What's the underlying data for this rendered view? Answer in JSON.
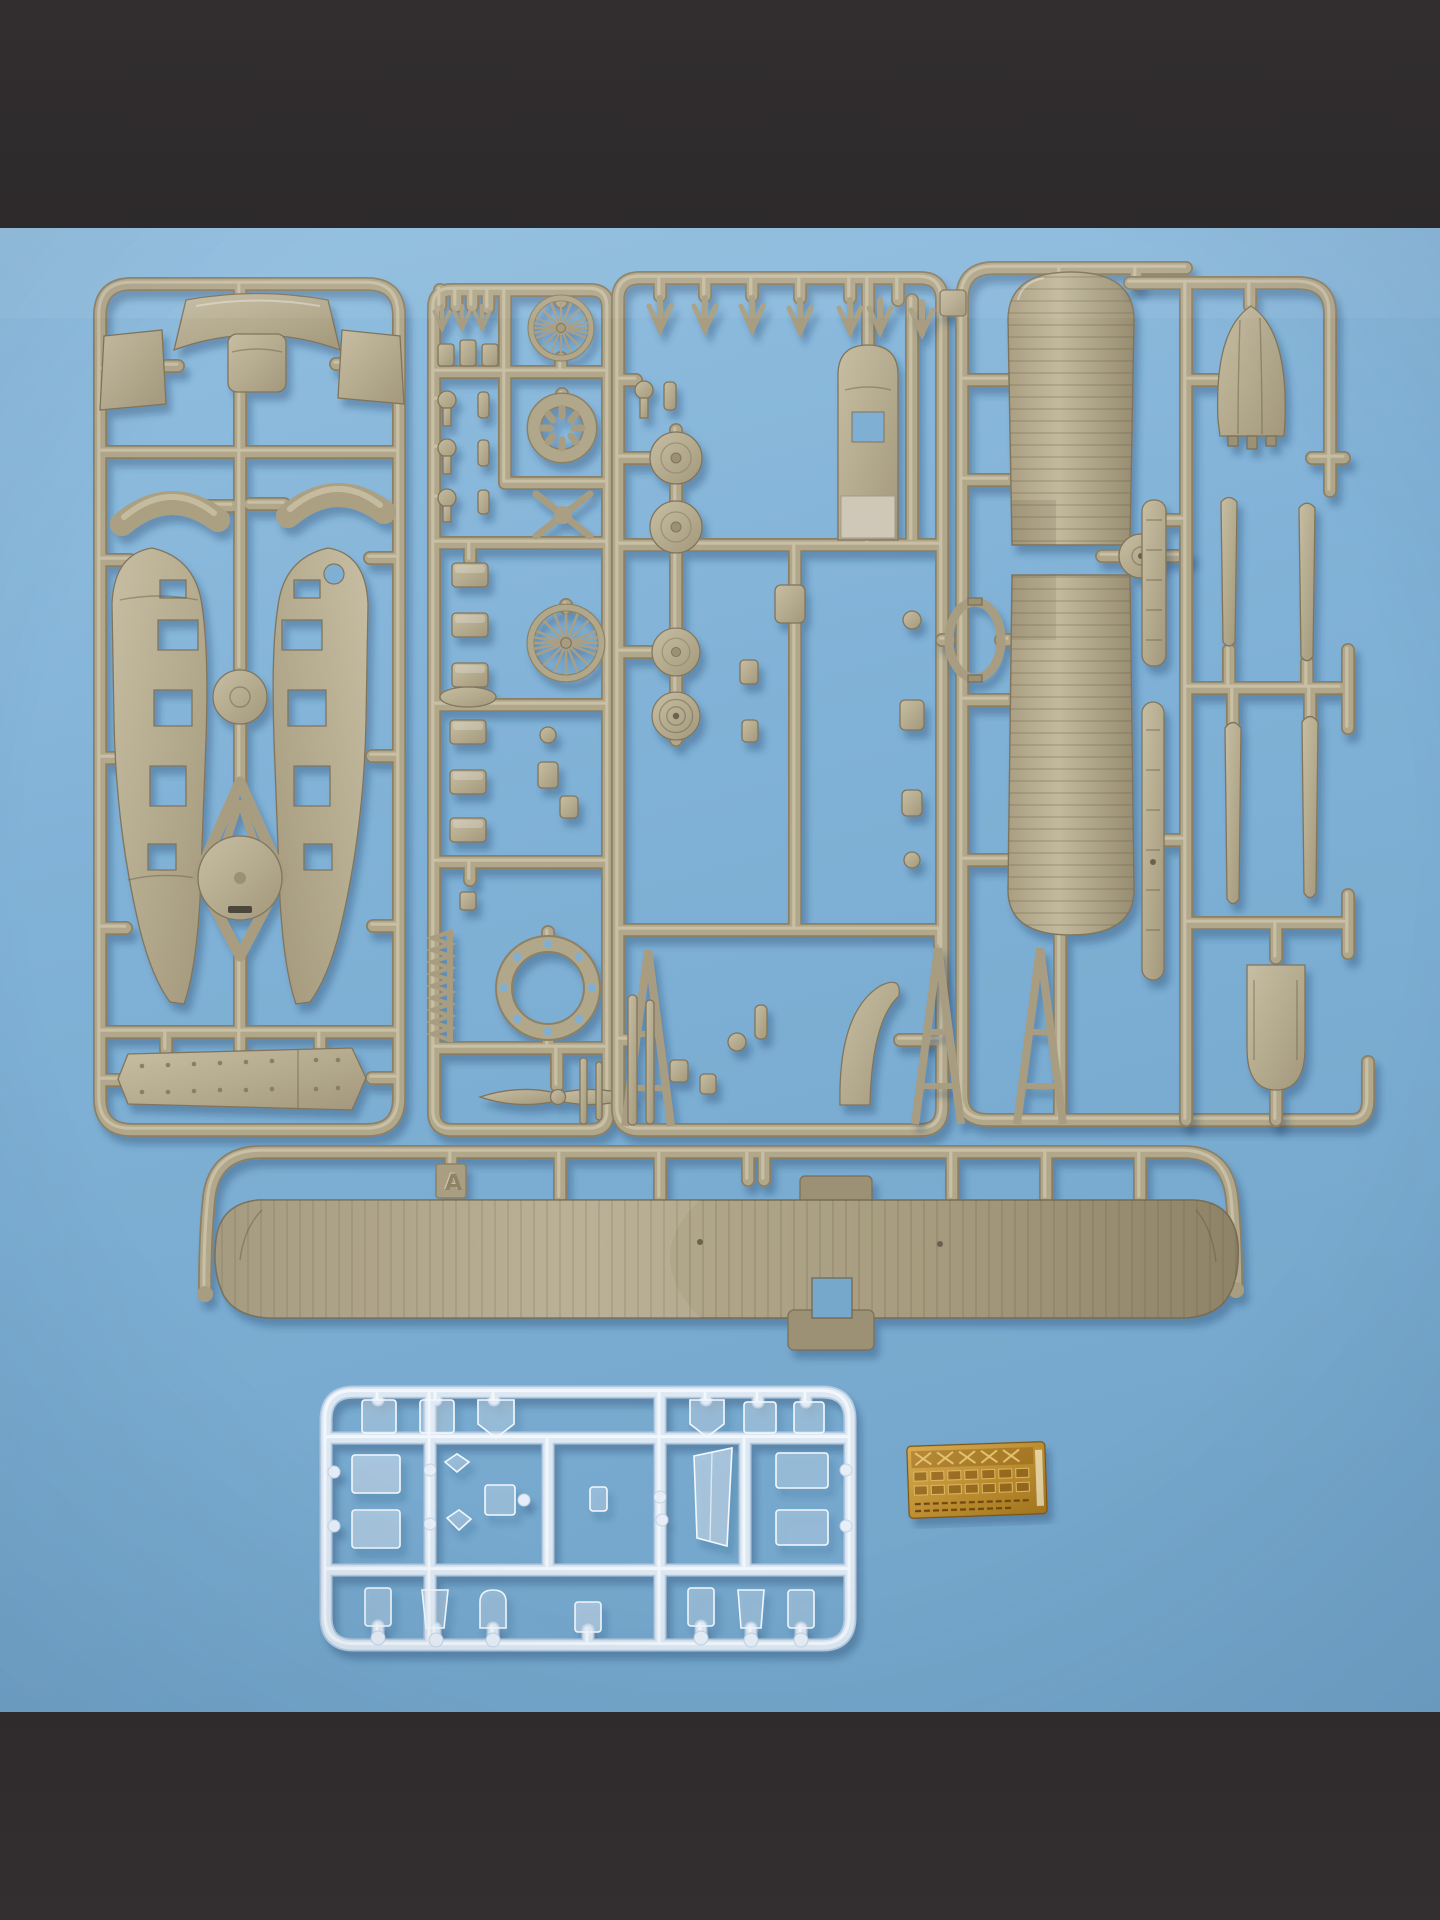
{
  "scene": {
    "type": "flat-lay photograph",
    "subject": "injection-moulded model aircraft kit sprues on a pale blue backdrop",
    "letterbox_color": "#302c2e",
    "backdrop_color": "#81b1d5",
    "styrene_color": "#b1a78b",
    "clear_styrene_color": "#dde8f3",
    "photo_etch_brass_color": "#bf8c33"
  },
  "markings": {
    "gate_tab_letter": "A"
  },
  "sprues": [
    {
      "id": "fuselage-sprue",
      "material": "tan styrene",
      "parts": [
        "fuselage half left",
        "fuselage half right",
        "cockpit decking",
        "side panels",
        "cowling strips",
        "inspection disc",
        "cabane A-frame with disc",
        "riveted cockpit floor"
      ]
    },
    {
      "id": "engine-and-wheels-sprue",
      "material": "tan styrene",
      "parts": [
        "spoked wheel",
        "rotary engine ring",
        "second spoked wheel",
        "cowling ring",
        "two-blade propeller",
        "exhaust comb",
        "small fittings"
      ]
    },
    {
      "id": "detail-sprue",
      "material": "tan styrene",
      "parts": [
        "wheel discs",
        "rear decking",
        "oval former",
        "V-struts",
        "undercarriage A-frames",
        "curved fairing"
      ]
    },
    {
      "id": "upper-wing-sprue",
      "material": "tan styrene",
      "parts": [
        "upper wing panel left",
        "upper wing panel right",
        "hub discs",
        "ailerons"
      ]
    },
    {
      "id": "tail-sprue",
      "material": "tan styrene",
      "parts": [
        "fin and rudder",
        "interplane struts",
        "tailplane tip"
      ]
    },
    {
      "id": "lower-wing-runner",
      "material": "tan styrene",
      "parts": [
        "one-piece lower wing"
      ]
    },
    {
      "id": "clear-sprue",
      "material": "clear styrene",
      "parts": [
        "windscreen",
        "cabin side windows",
        "roof panes",
        "small lenses"
      ]
    },
    {
      "id": "photo-etch-fret",
      "material": "brass",
      "parts": [
        "seat harness lattice",
        "instrument bezels",
        "small brackets"
      ]
    }
  ]
}
